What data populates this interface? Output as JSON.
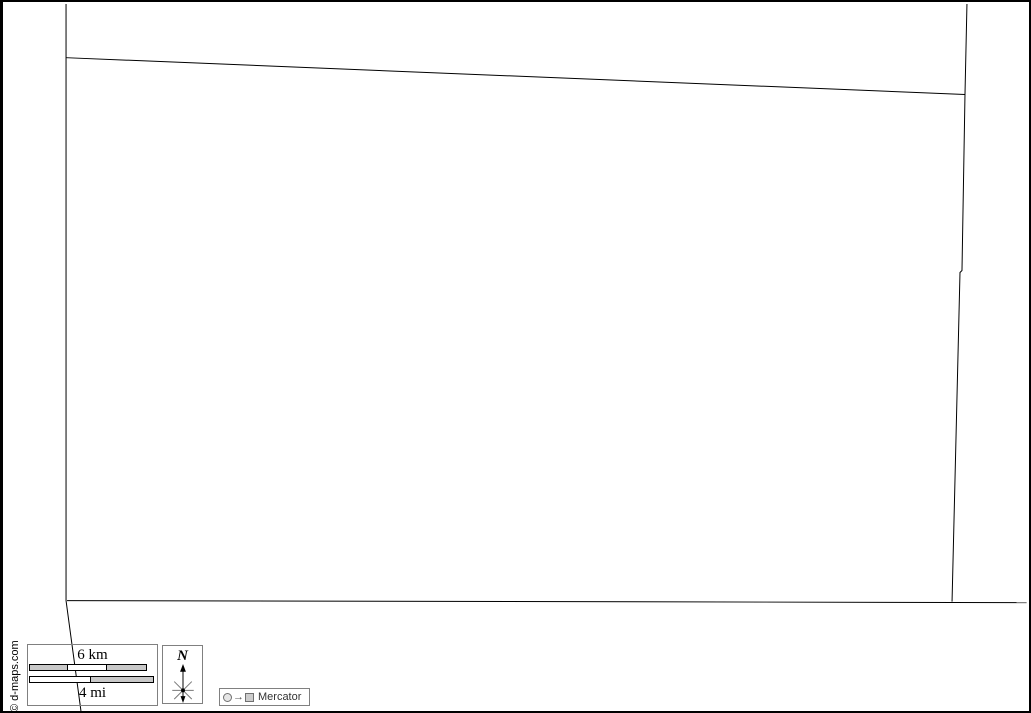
{
  "page": {
    "background": "#ffffff",
    "frame_color": "#000000"
  },
  "map": {
    "description": "blank-territory-outline-map",
    "stroke_color": "#000000",
    "boundaries": {
      "left": "63,2 63,602 78,713",
      "top": "63,56 967,93",
      "right": "969,2 967,94 964,270 962,272 954,603",
      "bottom": "64,602 1029,604"
    }
  },
  "scale_bar": {
    "km_label": "6 km",
    "mi_label": "4 mi",
    "km_segments": [
      {
        "width": 39,
        "color": "#c8c8c8"
      },
      {
        "width": 39,
        "color": "#ffffff"
      },
      {
        "width": 40,
        "color": "#c8c8c8"
      }
    ],
    "mi_segments": [
      {
        "width": 62,
        "color": "#ffffff"
      },
      {
        "width": 63,
        "color": "#c8c8c8"
      }
    ]
  },
  "compass": {
    "north_label": "N"
  },
  "projection": {
    "arrow_glyph": "→",
    "label": "Mercator"
  },
  "copyright": {
    "text": "© d-maps.com"
  }
}
